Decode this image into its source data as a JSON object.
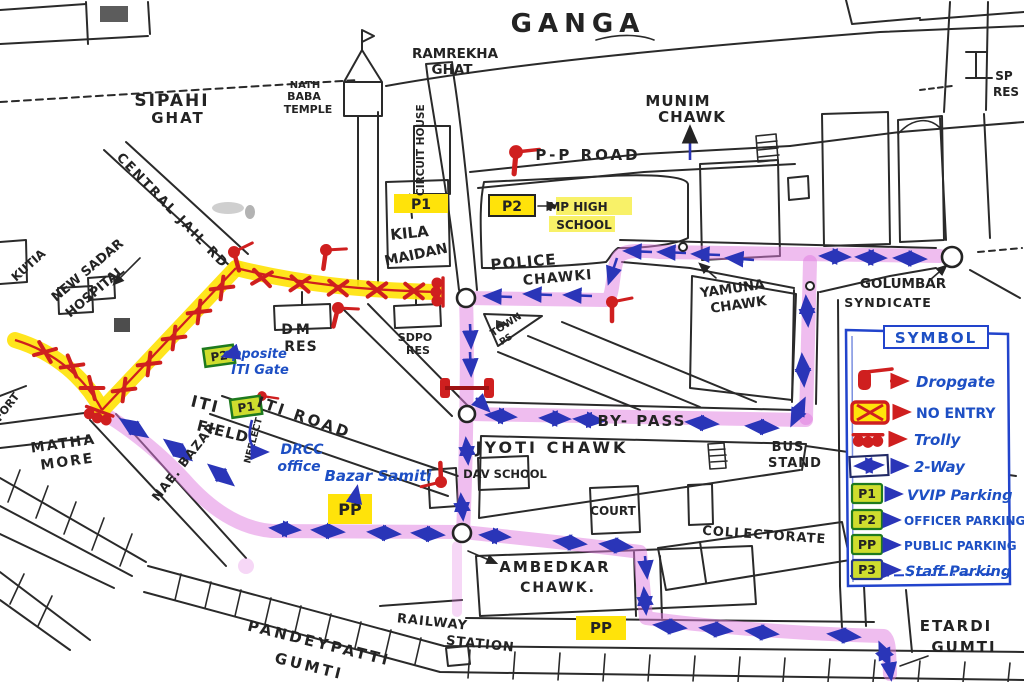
{
  "map": {
    "labels": {
      "ganga": "GANGA",
      "ramrekha_line1": "RAMREKHA",
      "ramrekha_line2": "GHAT",
      "sipahi_line1": "SIPAHI",
      "sipahi_line2": "GHAT",
      "temple_line1": "NATH",
      "temple_line2": "BABA",
      "temple_line3": "TEMPLE",
      "circuit_house": "CIRCUIT HOUSE",
      "munim_line1": "MUNIM",
      "munim_line2": "CHAWK",
      "pp_road": "P-P  ROAD",
      "sp_res_line1": "SP",
      "sp_res_line2": "RES",
      "central_jail_rd": "CENTRAL JAIL RD",
      "kutia": "KUTIA",
      "hospital_line1": "NEW SADAR",
      "hospital_line2": "HOSPITAL",
      "kila_line1": "KILA",
      "kila_line2": "MAIDAN",
      "mp_school_line1": "MP HIGH",
      "mp_school_line2": "SCHOOL",
      "police_line1": "POLICE",
      "police_line2": "CHAWKI",
      "yamuna_line1": "YAMUNA",
      "yamuna_line2": "CHAWK",
      "golumbar_line1": "GOLUMBAR",
      "golumbar_line2": "SYNDICATE",
      "dm_res_line1": "DM",
      "dm_res_line2": "RES",
      "sdpo_res_line1": "SDPO",
      "sdpo_res_line2": "RES",
      "town_line1": "TOWN",
      "town_line2": "PS",
      "opposite_line1": "opposite",
      "opposite_line2": "ITI Gate",
      "iti_road": "ITI ROAD",
      "iti_field_line1": "ITI",
      "iti_field_line2": "FIELD",
      "neelect": "NEELECT",
      "drcc_line1": "DRCC",
      "drcc_line2": "office",
      "bazar_samiti": "Bazar Samiti",
      "jyoti_chawk": "JYOTI CHAWK",
      "dav_school": "DAV SCHOOL",
      "by_pass": "BY- PASS",
      "bus_line1": "BUS",
      "bus_line2": "STAND",
      "court": "COURT",
      "collectorate": "COLLECTORATE",
      "ambedkar_line1": "AMBEDKAR",
      "ambedkar_line2": "CHAWK.",
      "railway_line1": "RAILWAY",
      "railway_line2": "STATION",
      "pandeypatti_line1": "PANDEYPATTI",
      "pandeypatti_line2": "GUMTI",
      "etardi_line1": "ETARDI",
      "etardi_line2": "GUMTI",
      "matha_line1": "MATHA",
      "matha_line2": "MORE",
      "nae_bazar": "NAE. BAZAR",
      "fort": "FORT"
    },
    "parking": {
      "kila_p1": "P1",
      "school_p2": "P2",
      "iti_gate_p2": "P2",
      "iti_field_p1": "P1",
      "samiti_pp": "PP",
      "station_pp": "PP"
    },
    "colors": {
      "no_entry_route": "#ffe30a",
      "two_way_route": "#e07ce0",
      "direction_arrows": "#2a35b8",
      "restriction_marks": "#cf1f1f",
      "handwritten_notes": "#1d4fc4",
      "parking_fill": "#cfdd2e",
      "parking_border": "#1e7a1e"
    }
  },
  "legend": {
    "title": "SYMBOL",
    "items": [
      {
        "id": "dropgate",
        "label": "Dropgate"
      },
      {
        "id": "no-entry",
        "label": "NO ENTRY"
      },
      {
        "id": "trolly",
        "label": "Trolly"
      },
      {
        "id": "two-way",
        "label": "2-Way"
      },
      {
        "id": "p1",
        "badge": "P1",
        "label": "VVIP Parking"
      },
      {
        "id": "p2",
        "badge": "P2",
        "label": "OFFICER PARKING"
      },
      {
        "id": "pp",
        "badge": "PP",
        "label": "PUBLIC PARKING"
      },
      {
        "id": "p3",
        "badge": "P3",
        "label": "Staff Parking"
      }
    ]
  }
}
